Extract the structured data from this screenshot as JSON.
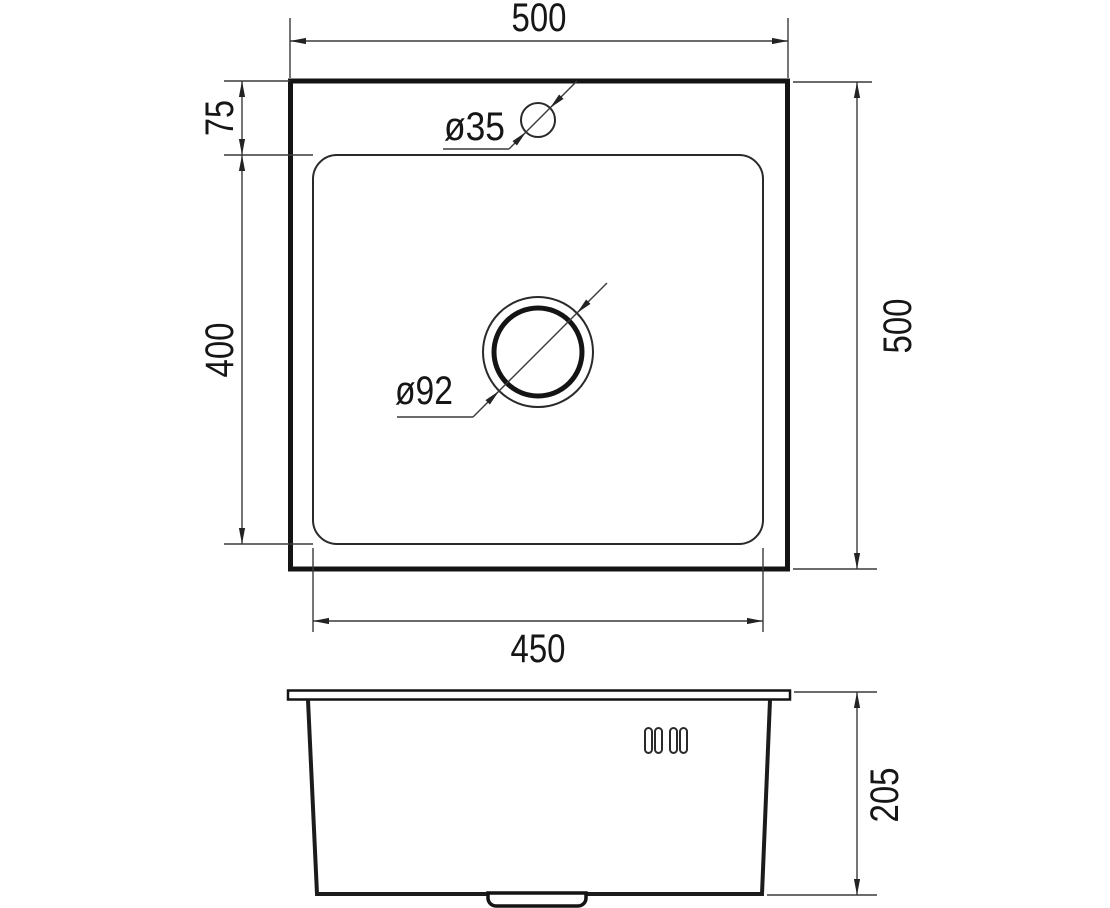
{
  "diagram": {
    "type": "technical-drawing",
    "subject": "square kitchen sink, top view and front section view",
    "colors": {
      "background": "#ffffff",
      "line": "#1c1c1c",
      "text": "#161616"
    },
    "views": {
      "top": {
        "labels": {
          "overall_width_top": "500",
          "overall_depth_right": "500",
          "faucet_offset_left": "75",
          "bowl_length_left": "400",
          "bowl_width_bottom": "450",
          "faucet_hole_diameter": "ø35",
          "drain_hole_diameter": "ø92"
        }
      },
      "front": {
        "labels": {
          "bowl_height_right": "205"
        }
      }
    }
  }
}
